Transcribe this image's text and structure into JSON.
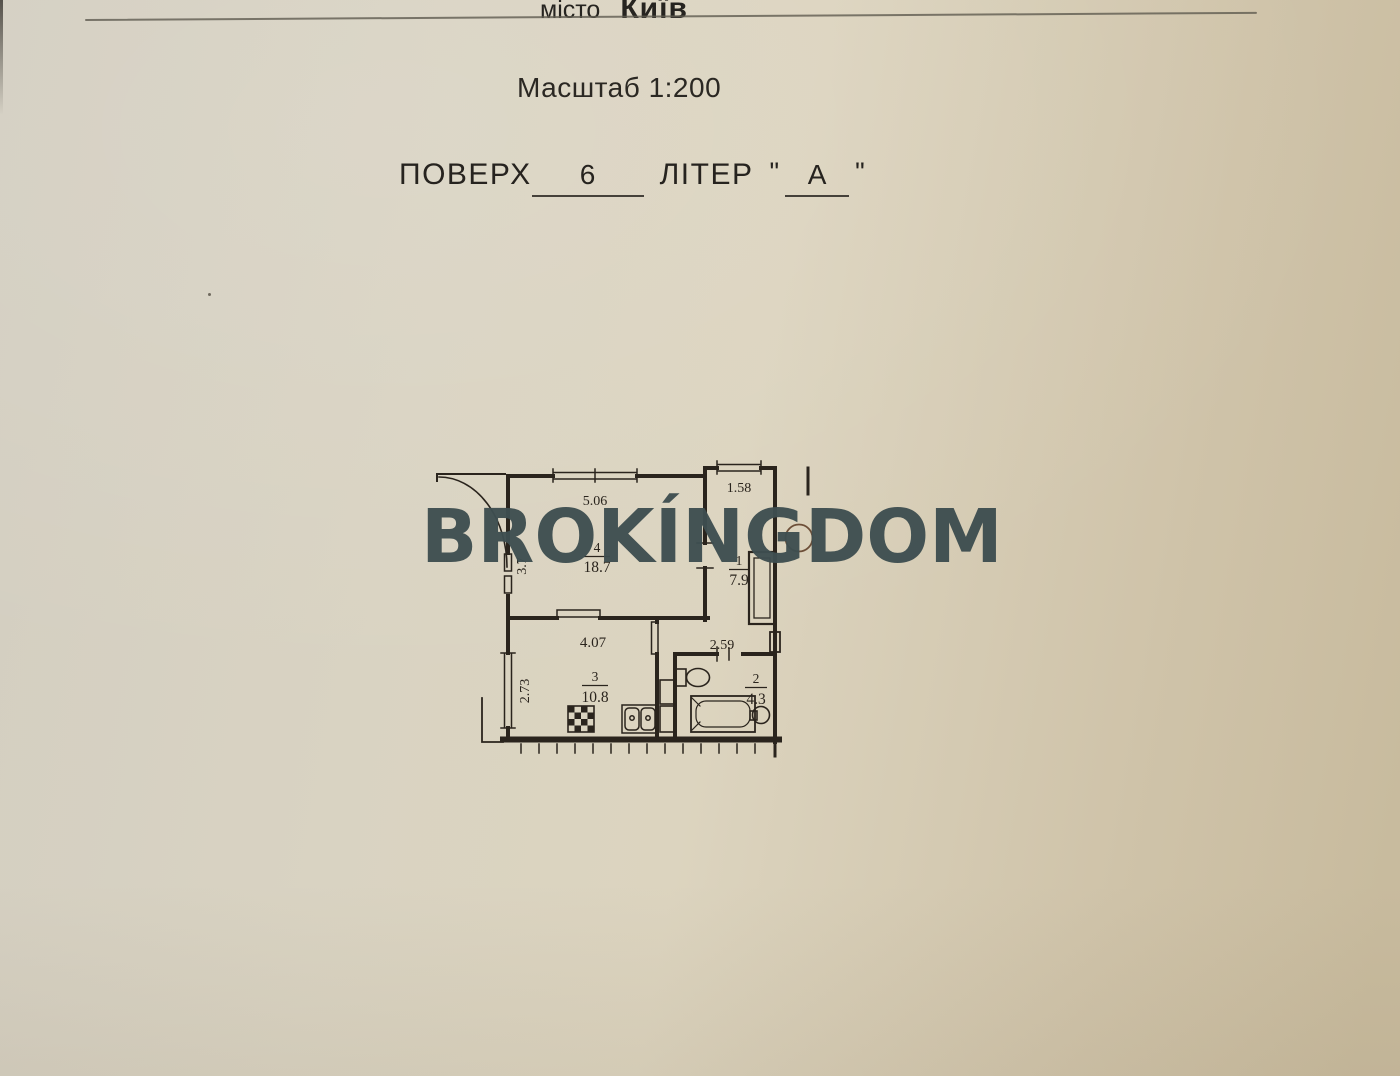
{
  "document": {
    "city_label": "місто",
    "city_value": "Київ",
    "scale_text": "Масштаб 1:200",
    "floor_label": "ПОВЕРХ",
    "floor_value": "6",
    "letter_label": "ЛІТЕР",
    "quote_open": "\"",
    "quote_close": "\"",
    "letter_value": "А"
  },
  "watermark": {
    "text": "BROKÍNGDOM"
  },
  "plan": {
    "rooms": {
      "living": {
        "number": "4",
        "area": "18.7",
        "dim_top": "5.06",
        "dim_side": "3.7"
      },
      "hall": {
        "number": "1",
        "area": "7.9",
        "dim_top": "1.58"
      },
      "kitchen": {
        "number": "3",
        "area": "10.8",
        "dim_top": "4.07",
        "dim_side": "2.73"
      },
      "bathroom": {
        "number": "2",
        "area": "4.3",
        "dim_top": "2.59"
      }
    }
  },
  "colors": {
    "paper": "#d7d0bd",
    "ink": "#2a241d",
    "watermark": "#3e4e50",
    "stamp_circle": "#6d4f38"
  }
}
